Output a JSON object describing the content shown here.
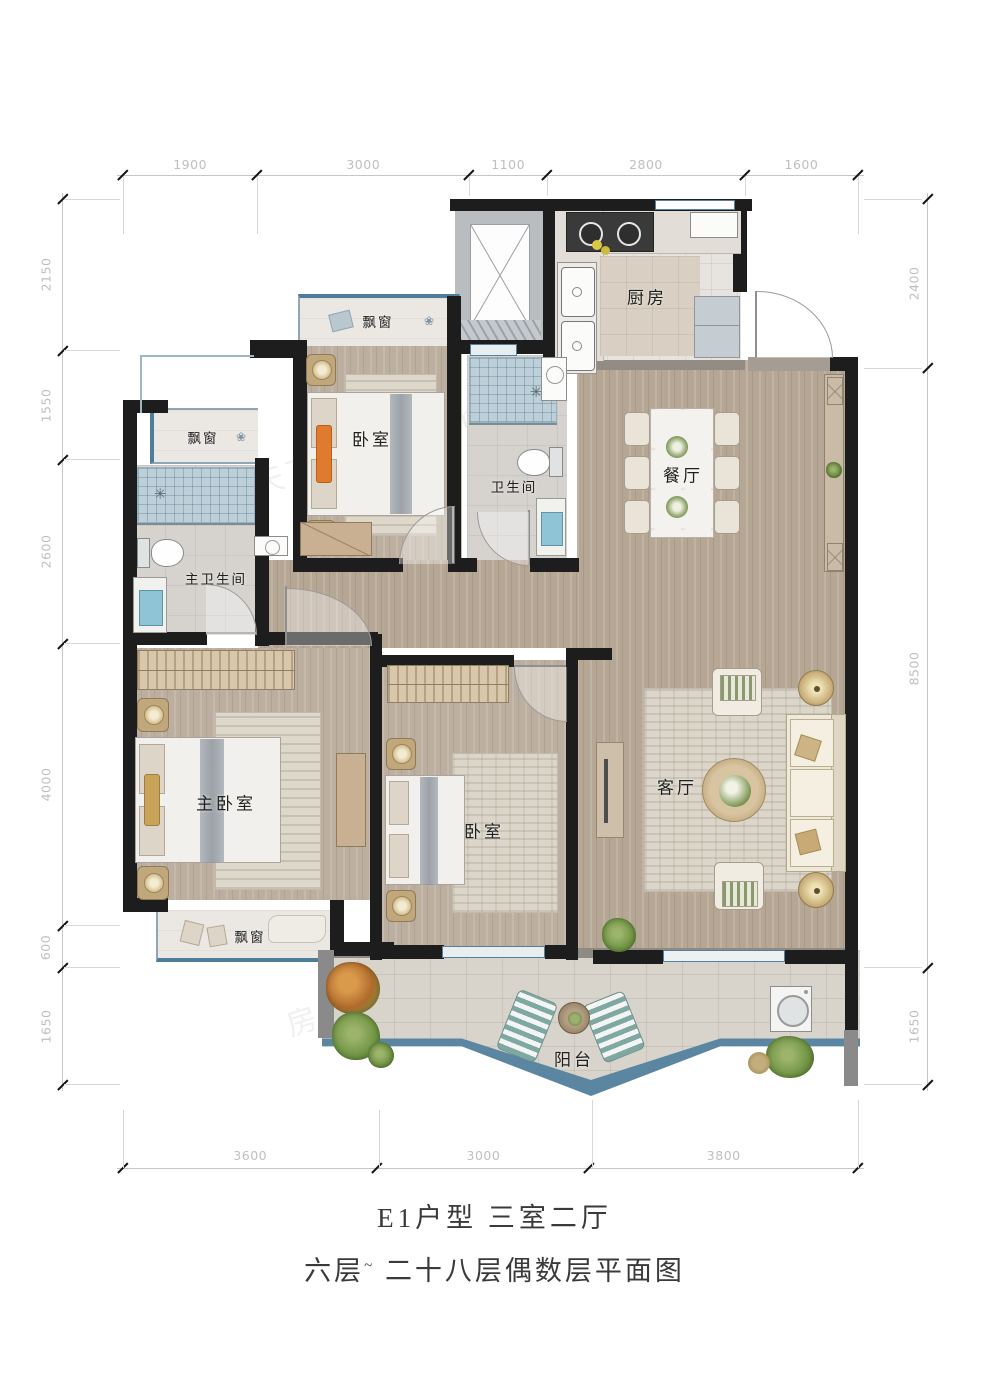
{
  "title": {
    "line1": "E1户型 三室二厅",
    "line2_prefix": "六层",
    "line2_sup": "~",
    "line2_suffix": "二十八层偶数层平面图"
  },
  "rooms": {
    "kitchen": "厨房",
    "dining": "餐厅",
    "bedroom_top": "卧室",
    "bathroom": "卫生间",
    "master_bathroom": "主卫生间",
    "master_bedroom": "主卧室",
    "bedroom_mid": "卧室",
    "living": "客厅",
    "balcony": "阳台",
    "bay_window_top": "飘窗",
    "bay_window_left": "飘窗",
    "bay_window_bottom": "飘窗"
  },
  "dimensions": {
    "top": [
      "1900",
      "3000",
      "1100",
      "2800",
      "1600"
    ],
    "bottom": [
      "3600",
      "3000",
      "3800"
    ],
    "left": [
      "2150",
      "1550",
      "2600",
      "4000",
      "600",
      "1650"
    ],
    "right": [
      "2400",
      "8500",
      "1650"
    ]
  },
  "icons": {
    "shower": "✳",
    "flower": "❀"
  },
  "watermark": "房天下 fang.com",
  "colors": {
    "wall": "#1d1d1d",
    "window_blue": "#4d7d9b",
    "wood_floor": "#b6a795",
    "shower_tile": "#bdd0d9",
    "balcony_tile": "#d8d4cb",
    "accent_orange": "#e07a2e"
  }
}
